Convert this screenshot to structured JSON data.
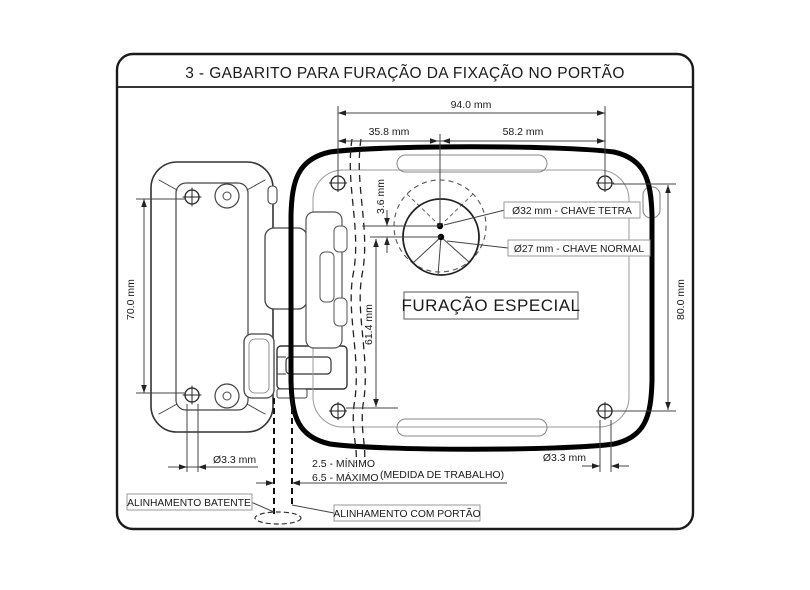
{
  "title": "3 - GABARITO PARA FURAÇÃO DA FIXAÇÃO NO PORTÃO",
  "dimensions": {
    "top_total": "94.0 mm",
    "top_left_span": "35.8 mm",
    "top_right_span": "58.2 mm",
    "key_center_offset": "3.6 mm",
    "key_to_bottom_hole": "61.4 mm",
    "lock_hole_spacing": "70.0 mm",
    "plate_hole_spacing": "80.0 mm",
    "hole_diameter_left": "Ø3.3 mm",
    "hole_diameter_right": "Ø3.3 mm"
  },
  "labels": {
    "key_tetra": "Ø32 mm - CHAVE TETRA",
    "key_normal": "Ø27 mm - CHAVE NORMAL",
    "special_drilling": "FURAÇÃO ESPECIAL",
    "gap_min": "2.5 - MÍNIMO",
    "gap_max": "6.5 - MÁXIMO",
    "work_measure": "(MEDIDA DE TRABALHO)",
    "alignment_stop": "ALINHAMENTO BATENTE",
    "alignment_gate": "ALINHAMENTO COM PORTÃO"
  },
  "colors": {
    "background": "#ffffff",
    "plate_outline": "#000000",
    "drawing_lines": "#333333",
    "dimension_lines": "#444444",
    "label_box_border": "#999999"
  }
}
